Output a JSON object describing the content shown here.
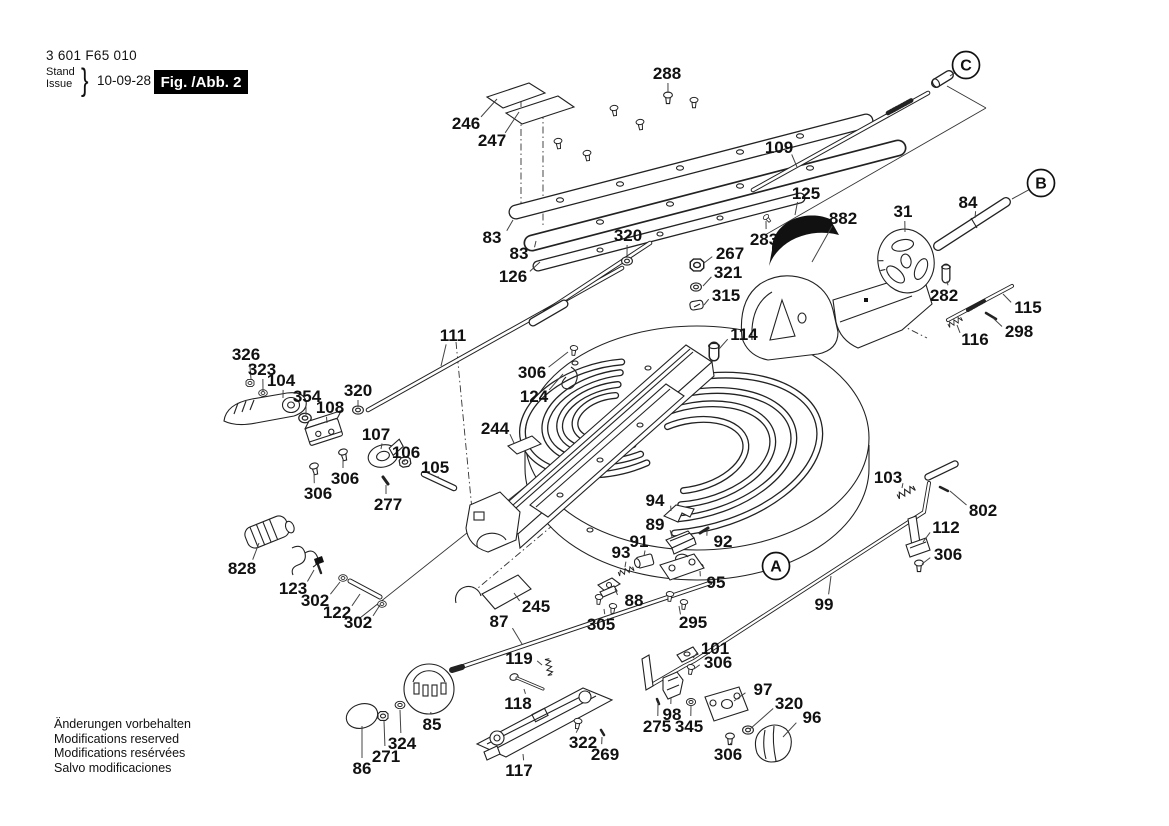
{
  "title_block": {
    "part_number": "3 601 F65 010",
    "stand_label": "Stand",
    "issue_label": "Issue",
    "brace": "}",
    "date": "10-09-28",
    "figure_label": "Fig. /Abb. 2"
  },
  "footer": {
    "lines": [
      "Änderungen vorbehalten",
      "Modifications reserved",
      "Modifications resérvées",
      "Salvo modificaciones"
    ]
  },
  "diagram": {
    "callouts": [
      {
        "label": "288",
        "x": 667,
        "y": 73,
        "tx": 668,
        "ty": 93
      },
      {
        "label": "246",
        "x": 466,
        "y": 123,
        "tx": 497,
        "ty": 99
      },
      {
        "label": "247",
        "x": 492,
        "y": 140,
        "tx": 519,
        "ty": 112
      },
      {
        "label": "109",
        "x": 779,
        "y": 147,
        "tx": 797,
        "ty": 167
      },
      {
        "label": "125",
        "x": 806,
        "y": 193,
        "tx": 795,
        "ty": 215
      },
      {
        "label": "882",
        "x": 843,
        "y": 218,
        "tx": 812,
        "ty": 262
      },
      {
        "label": "31",
        "x": 903,
        "y": 211,
        "tx": 905,
        "ty": 232
      },
      {
        "label": "84",
        "x": 968,
        "y": 202,
        "tx": 975,
        "ty": 218
      },
      {
        "label": "283",
        "x": 764,
        "y": 239,
        "tx": 766,
        "ty": 221
      },
      {
        "label": "83",
        "x": 492,
        "y": 237,
        "tx": 513,
        "ty": 220
      },
      {
        "label": "83",
        "x": 519,
        "y": 253,
        "tx": 536,
        "ty": 241
      },
      {
        "label": "320",
        "x": 628,
        "y": 235,
        "tx": 627,
        "ty": 256
      },
      {
        "label": "126",
        "x": 513,
        "y": 276,
        "tx": 540,
        "ty": 262
      },
      {
        "label": "267",
        "x": 730,
        "y": 253,
        "tx": 704,
        "ty": 263
      },
      {
        "label": "321",
        "x": 728,
        "y": 272,
        "tx": 703,
        "ty": 286
      },
      {
        "label": "315",
        "x": 726,
        "y": 295,
        "tx": 704,
        "ty": 305
      },
      {
        "label": "282",
        "x": 944,
        "y": 295,
        "tx": 947,
        "ty": 281
      },
      {
        "label": "115",
        "x": 1028,
        "y": 307,
        "tx": 1003,
        "ty": 294
      },
      {
        "label": "298",
        "x": 1019,
        "y": 331,
        "tx": 993,
        "ty": 318
      },
      {
        "label": "116",
        "x": 975,
        "y": 339,
        "tx": 957,
        "ty": 325
      },
      {
        "label": "111",
        "x": 453,
        "y": 335,
        "tx": 441,
        "ty": 366
      },
      {
        "label": "114",
        "x": 744,
        "y": 334,
        "tx": 719,
        "ty": 349
      },
      {
        "label": "306",
        "x": 532,
        "y": 372,
        "tx": 568,
        "ty": 352
      },
      {
        "label": "124",
        "x": 534,
        "y": 396,
        "tx": 563,
        "ty": 374
      },
      {
        "label": "326",
        "x": 246,
        "y": 354,
        "tx": 251,
        "ty": 379
      },
      {
        "label": "323",
        "x": 262,
        "y": 369,
        "tx": 263,
        "ty": 391
      },
      {
        "label": "104",
        "x": 281,
        "y": 380,
        "tx": 283,
        "ty": 398
      },
      {
        "label": "354",
        "x": 307,
        "y": 396,
        "tx": 306,
        "ty": 415
      },
      {
        "label": "108",
        "x": 330,
        "y": 407,
        "tx": 327,
        "ty": 423
      },
      {
        "label": "320",
        "x": 358,
        "y": 390,
        "tx": 358,
        "ty": 407
      },
      {
        "label": "107",
        "x": 376,
        "y": 434,
        "tx": 381,
        "ty": 449
      },
      {
        "label": "106",
        "x": 406,
        "y": 452,
        "tx": 405,
        "ty": 460
      },
      {
        "label": "105",
        "x": 435,
        "y": 467,
        "tx": 437,
        "ty": 477
      },
      {
        "label": "244",
        "x": 495,
        "y": 428,
        "tx": 514,
        "ty": 443
      },
      {
        "label": "306",
        "x": 318,
        "y": 493,
        "tx": 314,
        "ty": 473
      },
      {
        "label": "306",
        "x": 345,
        "y": 478,
        "tx": 343,
        "ty": 459
      },
      {
        "label": "277",
        "x": 388,
        "y": 504,
        "tx": 386,
        "ty": 485
      },
      {
        "label": "103",
        "x": 888,
        "y": 477,
        "tx": 902,
        "ty": 488
      },
      {
        "label": "802",
        "x": 983,
        "y": 510,
        "tx": 950,
        "ty": 491
      },
      {
        "label": "112",
        "x": 946,
        "y": 527,
        "tx": 923,
        "ty": 542
      },
      {
        "label": "306",
        "x": 948,
        "y": 554,
        "tx": 922,
        "ty": 564
      },
      {
        "label": "94",
        "x": 655,
        "y": 500,
        "tx": 671,
        "ty": 511
      },
      {
        "label": "89",
        "x": 655,
        "y": 524,
        "tx": 672,
        "ty": 537
      },
      {
        "label": "92",
        "x": 723,
        "y": 541,
        "tx": 707,
        "ty": 531
      },
      {
        "label": "91",
        "x": 639,
        "y": 541,
        "tx": 644,
        "ty": 556
      },
      {
        "label": "93",
        "x": 621,
        "y": 552,
        "tx": 625,
        "ty": 567
      },
      {
        "label": "95",
        "x": 716,
        "y": 582,
        "tx": 700,
        "ty": 571
      },
      {
        "label": "88",
        "x": 634,
        "y": 600,
        "tx": 615,
        "ty": 589
      },
      {
        "label": "295",
        "x": 693,
        "y": 622,
        "tx": 679,
        "ty": 606
      },
      {
        "label": "99",
        "x": 824,
        "y": 604,
        "tx": 831,
        "ty": 576
      },
      {
        "label": "828",
        "x": 242,
        "y": 568,
        "tx": 259,
        "ty": 543
      },
      {
        "label": "123",
        "x": 293,
        "y": 588,
        "tx": 314,
        "ty": 570
      },
      {
        "label": "302",
        "x": 315,
        "y": 600,
        "tx": 340,
        "ty": 582
      },
      {
        "label": "122",
        "x": 337,
        "y": 612,
        "tx": 360,
        "ty": 594
      },
      {
        "label": "302",
        "x": 358,
        "y": 622,
        "tx": 380,
        "ty": 605
      },
      {
        "label": "87",
        "x": 499,
        "y": 621,
        "tx": 522,
        "ty": 644
      },
      {
        "label": "245",
        "x": 536,
        "y": 606,
        "tx": 514,
        "ty": 593
      },
      {
        "label": "305",
        "x": 601,
        "y": 624,
        "tx": 604,
        "ty": 609
      },
      {
        "label": "119",
        "x": 519,
        "y": 658,
        "tx": 542,
        "ty": 665
      },
      {
        "label": "118",
        "x": 518,
        "y": 703,
        "tx": 524,
        "ty": 689
      },
      {
        "label": "85",
        "x": 432,
        "y": 724,
        "tx": 431,
        "ty": 712
      },
      {
        "label": "324",
        "x": 402,
        "y": 743,
        "tx": 400,
        "ty": 710
      },
      {
        "label": "271",
        "x": 386,
        "y": 756,
        "tx": 384,
        "ty": 721
      },
      {
        "label": "86",
        "x": 362,
        "y": 768,
        "tx": 362,
        "ty": 726
      },
      {
        "label": "117",
        "x": 519,
        "y": 770,
        "tx": 523,
        "ty": 754
      },
      {
        "label": "322",
        "x": 583,
        "y": 742,
        "tx": 578,
        "ty": 729
      },
      {
        "label": "269",
        "x": 605,
        "y": 754,
        "tx": 602,
        "ty": 737
      },
      {
        "label": "101",
        "x": 715,
        "y": 648,
        "tx": 693,
        "ty": 658
      },
      {
        "label": "306",
        "x": 718,
        "y": 662,
        "tx": 694,
        "ty": 669
      },
      {
        "label": "97",
        "x": 763,
        "y": 689,
        "tx": 734,
        "ty": 701
      },
      {
        "label": "320",
        "x": 789,
        "y": 703,
        "tx": 750,
        "ty": 729
      },
      {
        "label": "96",
        "x": 812,
        "y": 717,
        "tx": 783,
        "ty": 737
      },
      {
        "label": "98",
        "x": 672,
        "y": 714,
        "tx": 671,
        "ty": 698
      },
      {
        "label": "275",
        "x": 657,
        "y": 726,
        "tx": 658,
        "ty": 703
      },
      {
        "label": "345",
        "x": 689,
        "y": 726,
        "tx": 691,
        "ty": 705
      },
      {
        "label": "306",
        "x": 728,
        "y": 754,
        "tx": 730,
        "ty": 743
      }
    ],
    "view_letters": [
      {
        "label": "C",
        "x": 966,
        "y": 65,
        "tx": 950,
        "ty": 76
      },
      {
        "label": "B",
        "x": 1041,
        "y": 183,
        "tx": 1012,
        "ty": 199
      },
      {
        "label": "A",
        "x": 776,
        "y": 566
      }
    ]
  }
}
